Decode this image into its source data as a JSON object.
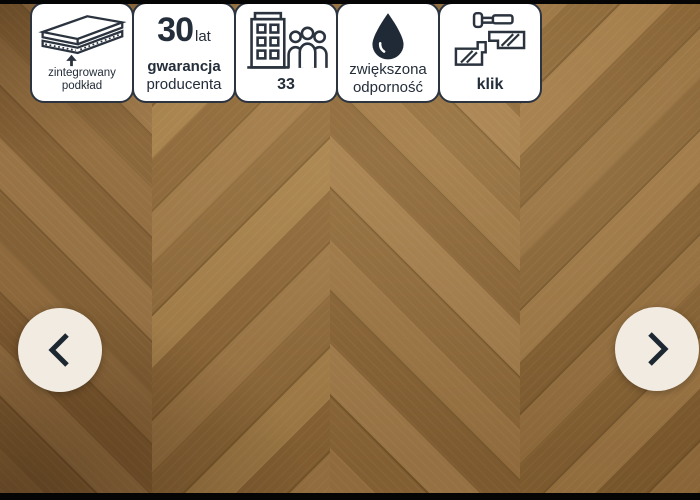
{
  "page": {
    "type": "product-image-carousel",
    "photo": "herringbone-oak-floor-panels"
  },
  "carousel": {
    "prev_icon": "chevron-left",
    "next_icon": "chevron-right",
    "button_bg": "#f1ebe2",
    "chevron_color": "#1d2732"
  },
  "badges": [
    {
      "name": "integrated-underlay",
      "icon": "integrated-underlay-icon",
      "lines": [
        "zintegrowany",
        "podkład"
      ]
    },
    {
      "name": "manufacturer-warranty",
      "value": "30",
      "unit": "lat",
      "lines": [
        "gwarancja",
        "producenta"
      ]
    },
    {
      "name": "usage-class",
      "icon": "building-people-icon",
      "value": "33"
    },
    {
      "name": "increased-resistance",
      "icon": "water-drop-icon",
      "lines": [
        "zwiększona",
        "odporność"
      ]
    },
    {
      "name": "click-install-system",
      "icon": "click-system-icon",
      "label": "klik"
    }
  ],
  "style": {
    "badge_bg": "#ffffff",
    "badge_border_color": "#2c343f",
    "badge_text_color": "#242e3a",
    "wood_base_color": "#9a7444",
    "letterbox_color": "#050505"
  }
}
